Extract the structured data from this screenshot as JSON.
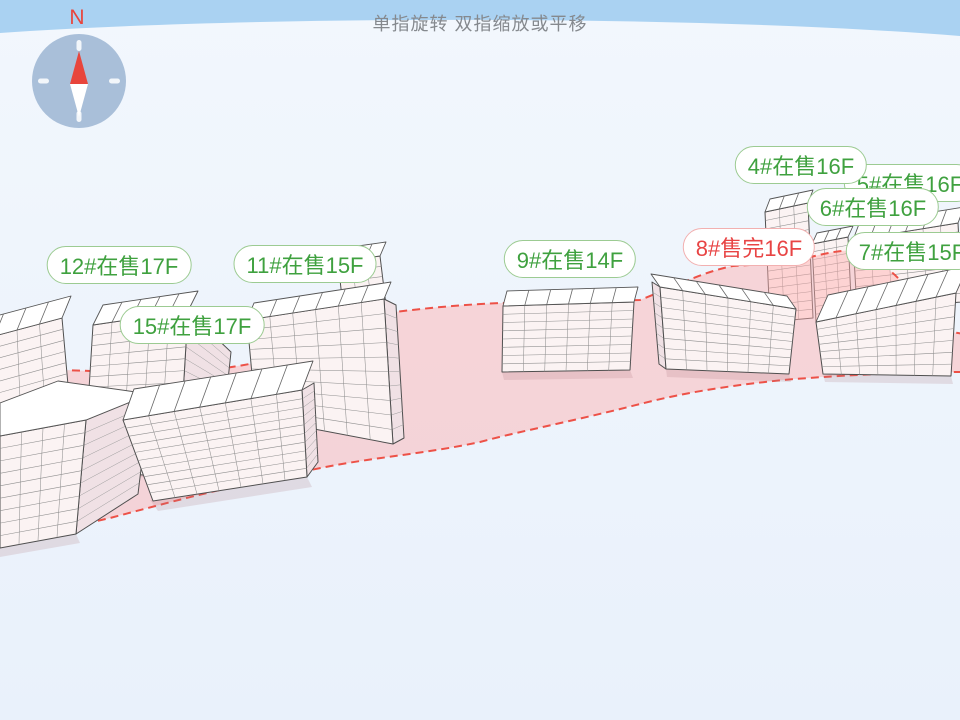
{
  "hint_text": "单指旋转 双指缩放或平移",
  "compass": {
    "north_label": "N"
  },
  "status_colors": {
    "selling_text": "#3fa13f",
    "selling_border": "#9ccb92",
    "sold_out_text": "#e84444",
    "sold_out_border": "#f2b0b0",
    "parcel_outline": "#ed5147"
  },
  "building_markers": [
    {
      "id": "12",
      "label": "12#在售17F",
      "status": "selling",
      "x": 119,
      "y": 265
    },
    {
      "id": "11",
      "label": "11#在售15F",
      "status": "selling",
      "x": 305,
      "y": 264
    },
    {
      "id": "15",
      "label": "15#在售17F",
      "status": "selling",
      "x": 192,
      "y": 325
    },
    {
      "id": "9",
      "label": "9#在售14F",
      "status": "selling",
      "x": 570,
      "y": 259
    },
    {
      "id": "5",
      "label": "5#在售16F",
      "status": "selling",
      "x": 910,
      "y": 183
    },
    {
      "id": "4",
      "label": "4#在售16F",
      "status": "selling",
      "x": 801,
      "y": 165
    },
    {
      "id": "6",
      "label": "6#在售16F",
      "status": "selling",
      "x": 873,
      "y": 207
    },
    {
      "id": "7",
      "label": "7#在售15F",
      "status": "selling",
      "x": 912,
      "y": 251
    },
    {
      "id": "8",
      "label": "8#售完16F",
      "status": "sold_out",
      "x": 749,
      "y": 247
    }
  ]
}
